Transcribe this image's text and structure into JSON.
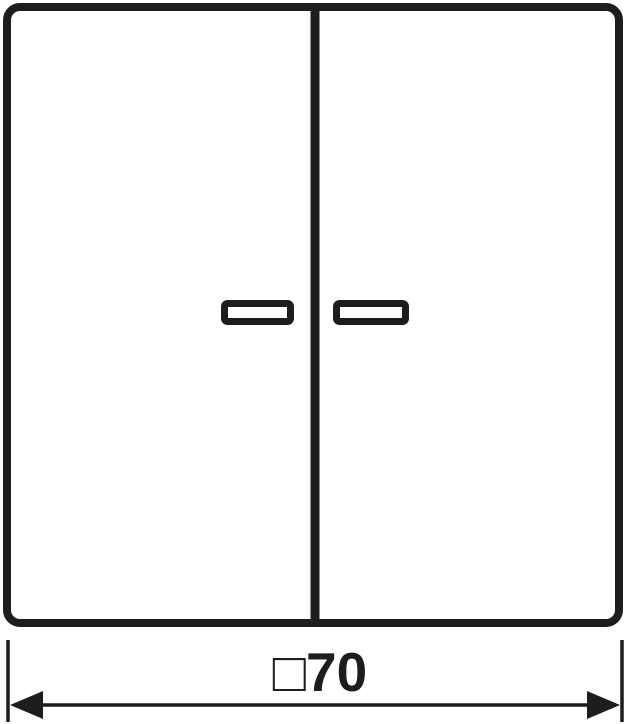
{
  "drawing": {
    "stroke_color": "#1d1d1b",
    "background_color": "#ffffff",
    "dimension_label": "□70"
  }
}
